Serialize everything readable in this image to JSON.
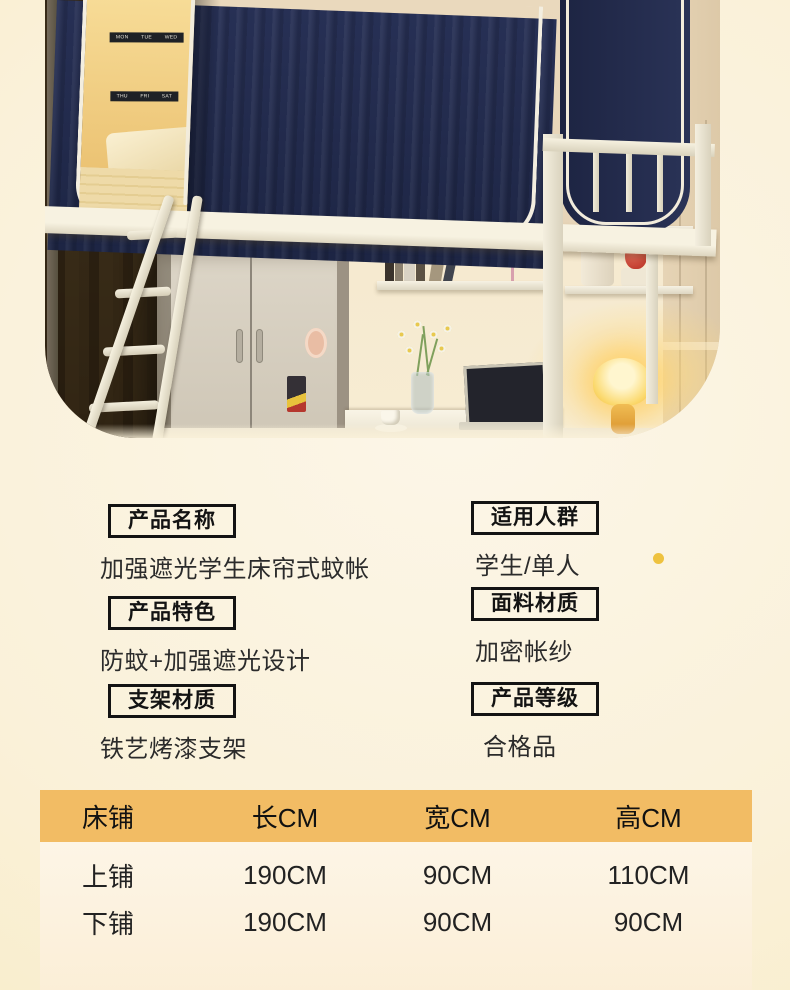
{
  "photo": {
    "posters": [
      {
        "days": [
          "MON",
          "TUE",
          "WED"
        ]
      },
      {
        "days": [
          "THU",
          "FRI",
          "SAT"
        ]
      }
    ]
  },
  "specs": {
    "groups_left": [
      {
        "label": "产品名称",
        "value": "加强遮光学生床帘式蚊帐"
      },
      {
        "label": "产品特色",
        "value": "防蚊+加强遮光设计"
      },
      {
        "label": "支架材质",
        "value": "铁艺烤漆支架"
      }
    ],
    "groups_right": [
      {
        "label": "适用人群",
        "value": "学生/单人"
      },
      {
        "label": "面料材质",
        "value": "加密帐纱"
      },
      {
        "label": "产品等级",
        "value": "合格品"
      }
    ]
  },
  "size_table": {
    "columns": [
      "床铺",
      "长CM",
      "宽CM",
      "高CM"
    ],
    "rows": [
      {
        "name": "上铺",
        "length": "190CM",
        "width": "90CM",
        "height": "110CM"
      },
      {
        "name": "下铺",
        "length": "190CM",
        "width": "90CM",
        "height": "90CM"
      }
    ]
  },
  "colors": {
    "table_header": "#f2bc64",
    "accent_dot": "#eec23f",
    "curtain_navy": "#232c4e"
  }
}
